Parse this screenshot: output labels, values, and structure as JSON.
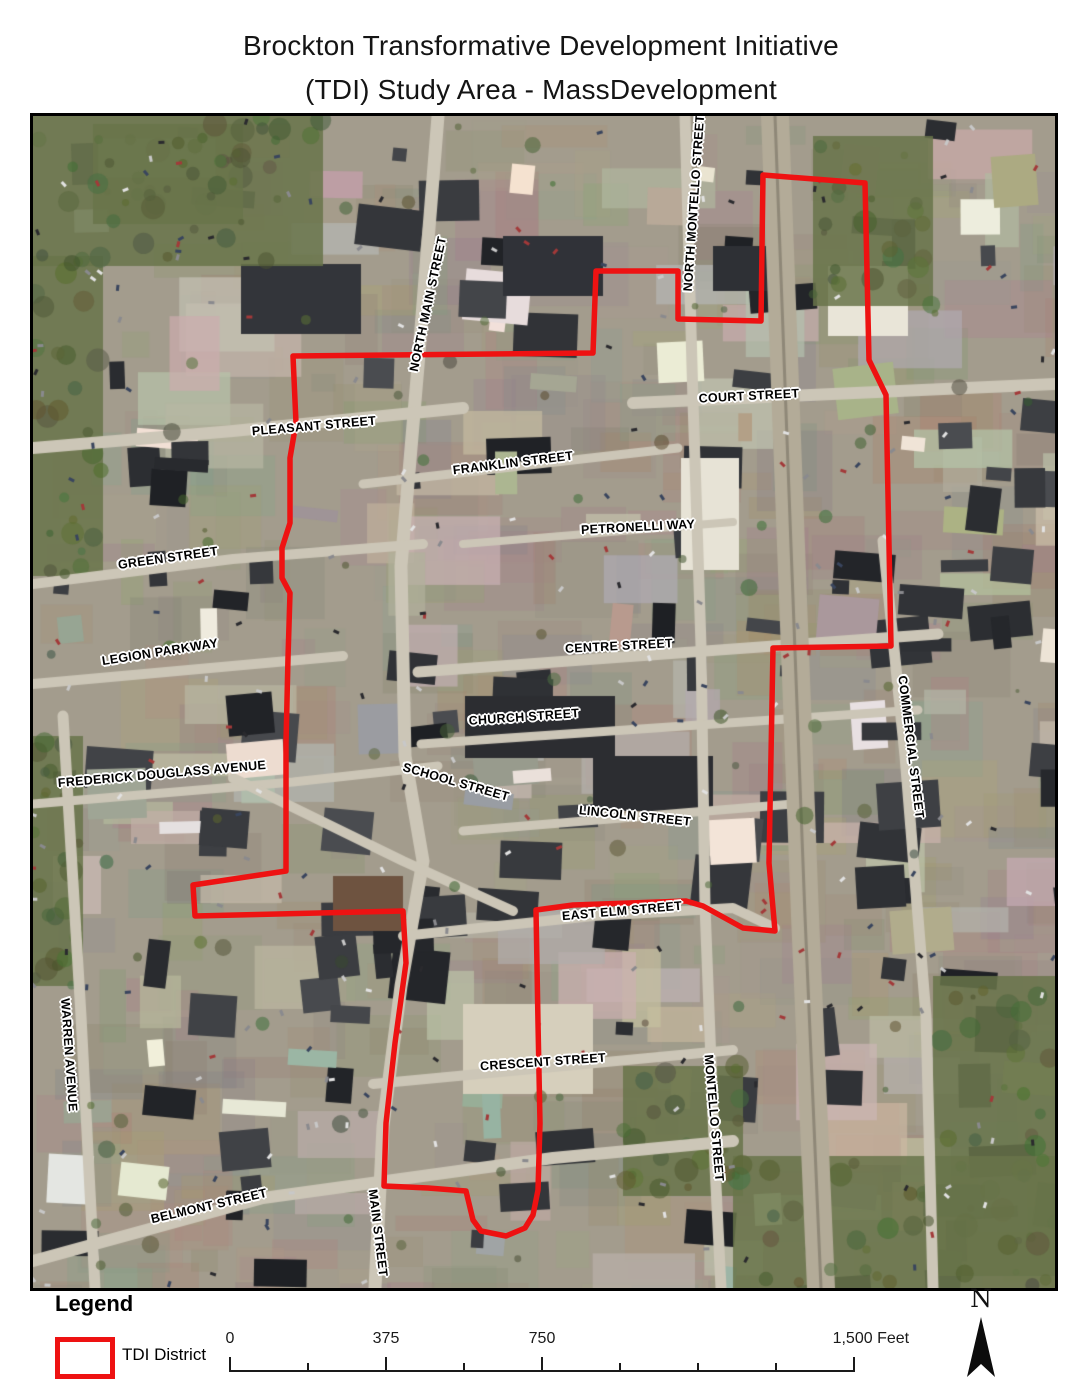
{
  "title": {
    "line1": "Brockton Transformative Development Initiative",
    "line2": "(TDI) Study Area - MassDevelopment"
  },
  "map": {
    "district_boundary": {
      "name": "TDI District boundary",
      "color": "#ee1212",
      "stroke_width": 5.5,
      "points": [
        [
          260,
          240
        ],
        [
          560,
          237
        ],
        [
          563,
          155
        ],
        [
          645,
          155
        ],
        [
          645,
          203
        ],
        [
          728,
          205
        ],
        [
          730,
          59
        ],
        [
          832,
          67
        ],
        [
          836,
          244
        ],
        [
          853,
          279
        ],
        [
          858,
          530
        ],
        [
          740,
          532
        ],
        [
          736,
          747
        ],
        [
          742,
          815
        ],
        [
          710,
          812
        ],
        [
          670,
          790
        ],
        [
          653,
          785
        ],
        [
          540,
          789
        ],
        [
          503,
          794
        ],
        [
          505,
          907
        ],
        [
          507,
          1007
        ],
        [
          505,
          1074
        ],
        [
          500,
          1099
        ],
        [
          492,
          1112
        ],
        [
          473,
          1120
        ],
        [
          448,
          1115
        ],
        [
          440,
          1104
        ],
        [
          433,
          1075
        ],
        [
          395,
          1072
        ],
        [
          351,
          1070
        ],
        [
          353,
          1007
        ],
        [
          362,
          927
        ],
        [
          373,
          847
        ],
        [
          370,
          795
        ],
        [
          162,
          800
        ],
        [
          160,
          769
        ],
        [
          253,
          755
        ],
        [
          253,
          627
        ],
        [
          255,
          542
        ],
        [
          257,
          477
        ],
        [
          249,
          462
        ],
        [
          249,
          432
        ],
        [
          257,
          407
        ],
        [
          257,
          342
        ],
        [
          263,
          307
        ]
      ]
    },
    "street_labels": [
      {
        "text": "NORTH MAIN STREET",
        "x": 395,
        "y": 188,
        "rot": -78
      },
      {
        "text": "NORTH MONTELLO STREET",
        "x": 661,
        "y": 87,
        "rot": -86
      },
      {
        "text": "COURT STREET",
        "x": 716,
        "y": 280,
        "rot": -3
      },
      {
        "text": "PLEASANT STREET",
        "x": 281,
        "y": 310,
        "rot": -5
      },
      {
        "text": "FRANKLIN STREET",
        "x": 480,
        "y": 347,
        "rot": -7
      },
      {
        "text": "PETRONELLI WAY",
        "x": 605,
        "y": 411,
        "rot": -3
      },
      {
        "text": "GREEN STREET",
        "x": 135,
        "y": 442,
        "rot": -8
      },
      {
        "text": "CENTRE STREET",
        "x": 586,
        "y": 530,
        "rot": -3
      },
      {
        "text": "LEGION PARKWAY",
        "x": 127,
        "y": 536,
        "rot": -9
      },
      {
        "text": "CHURCH STREET",
        "x": 491,
        "y": 601,
        "rot": -4
      },
      {
        "text": "FREDERICK DOUGLASS AVENUE",
        "x": 129,
        "y": 658,
        "rot": -5
      },
      {
        "text": "SCHOOL STREET",
        "x": 423,
        "y": 666,
        "rot": 16
      },
      {
        "text": "LINCOLN STREET",
        "x": 602,
        "y": 700,
        "rot": 6
      },
      {
        "text": "COMMERCIAL STREET",
        "x": 878,
        "y": 631,
        "rot": 83
      },
      {
        "text": "EAST ELM STREET",
        "x": 589,
        "y": 795,
        "rot": -5
      },
      {
        "text": "WARREN AVENUE",
        "x": 36,
        "y": 939,
        "rot": 86
      },
      {
        "text": "CRESCENT STREET",
        "x": 510,
        "y": 946,
        "rot": -4
      },
      {
        "text": "MONTELLO STREET",
        "x": 681,
        "y": 1002,
        "rot": 85
      },
      {
        "text": "BELMONT STREET",
        "x": 176,
        "y": 1090,
        "rot": -13
      },
      {
        "text": "MAIN STREET",
        "x": 345,
        "y": 1117,
        "rot": 83
      }
    ]
  },
  "legend": {
    "heading": "Legend",
    "item_label": "TDI District",
    "swatch_color": "#ee1212"
  },
  "scale_bar": {
    "labels": [
      {
        "text": "0",
        "frac": 0
      },
      {
        "text": "375",
        "frac": 0.25
      },
      {
        "text": "750",
        "frac": 0.5
      },
      {
        "text": "1,500 Feet",
        "frac": 1
      }
    ],
    "tick_count": 9,
    "major_ticks": [
      0,
      2,
      4,
      8
    ]
  },
  "north_arrow": {
    "label": "N"
  }
}
